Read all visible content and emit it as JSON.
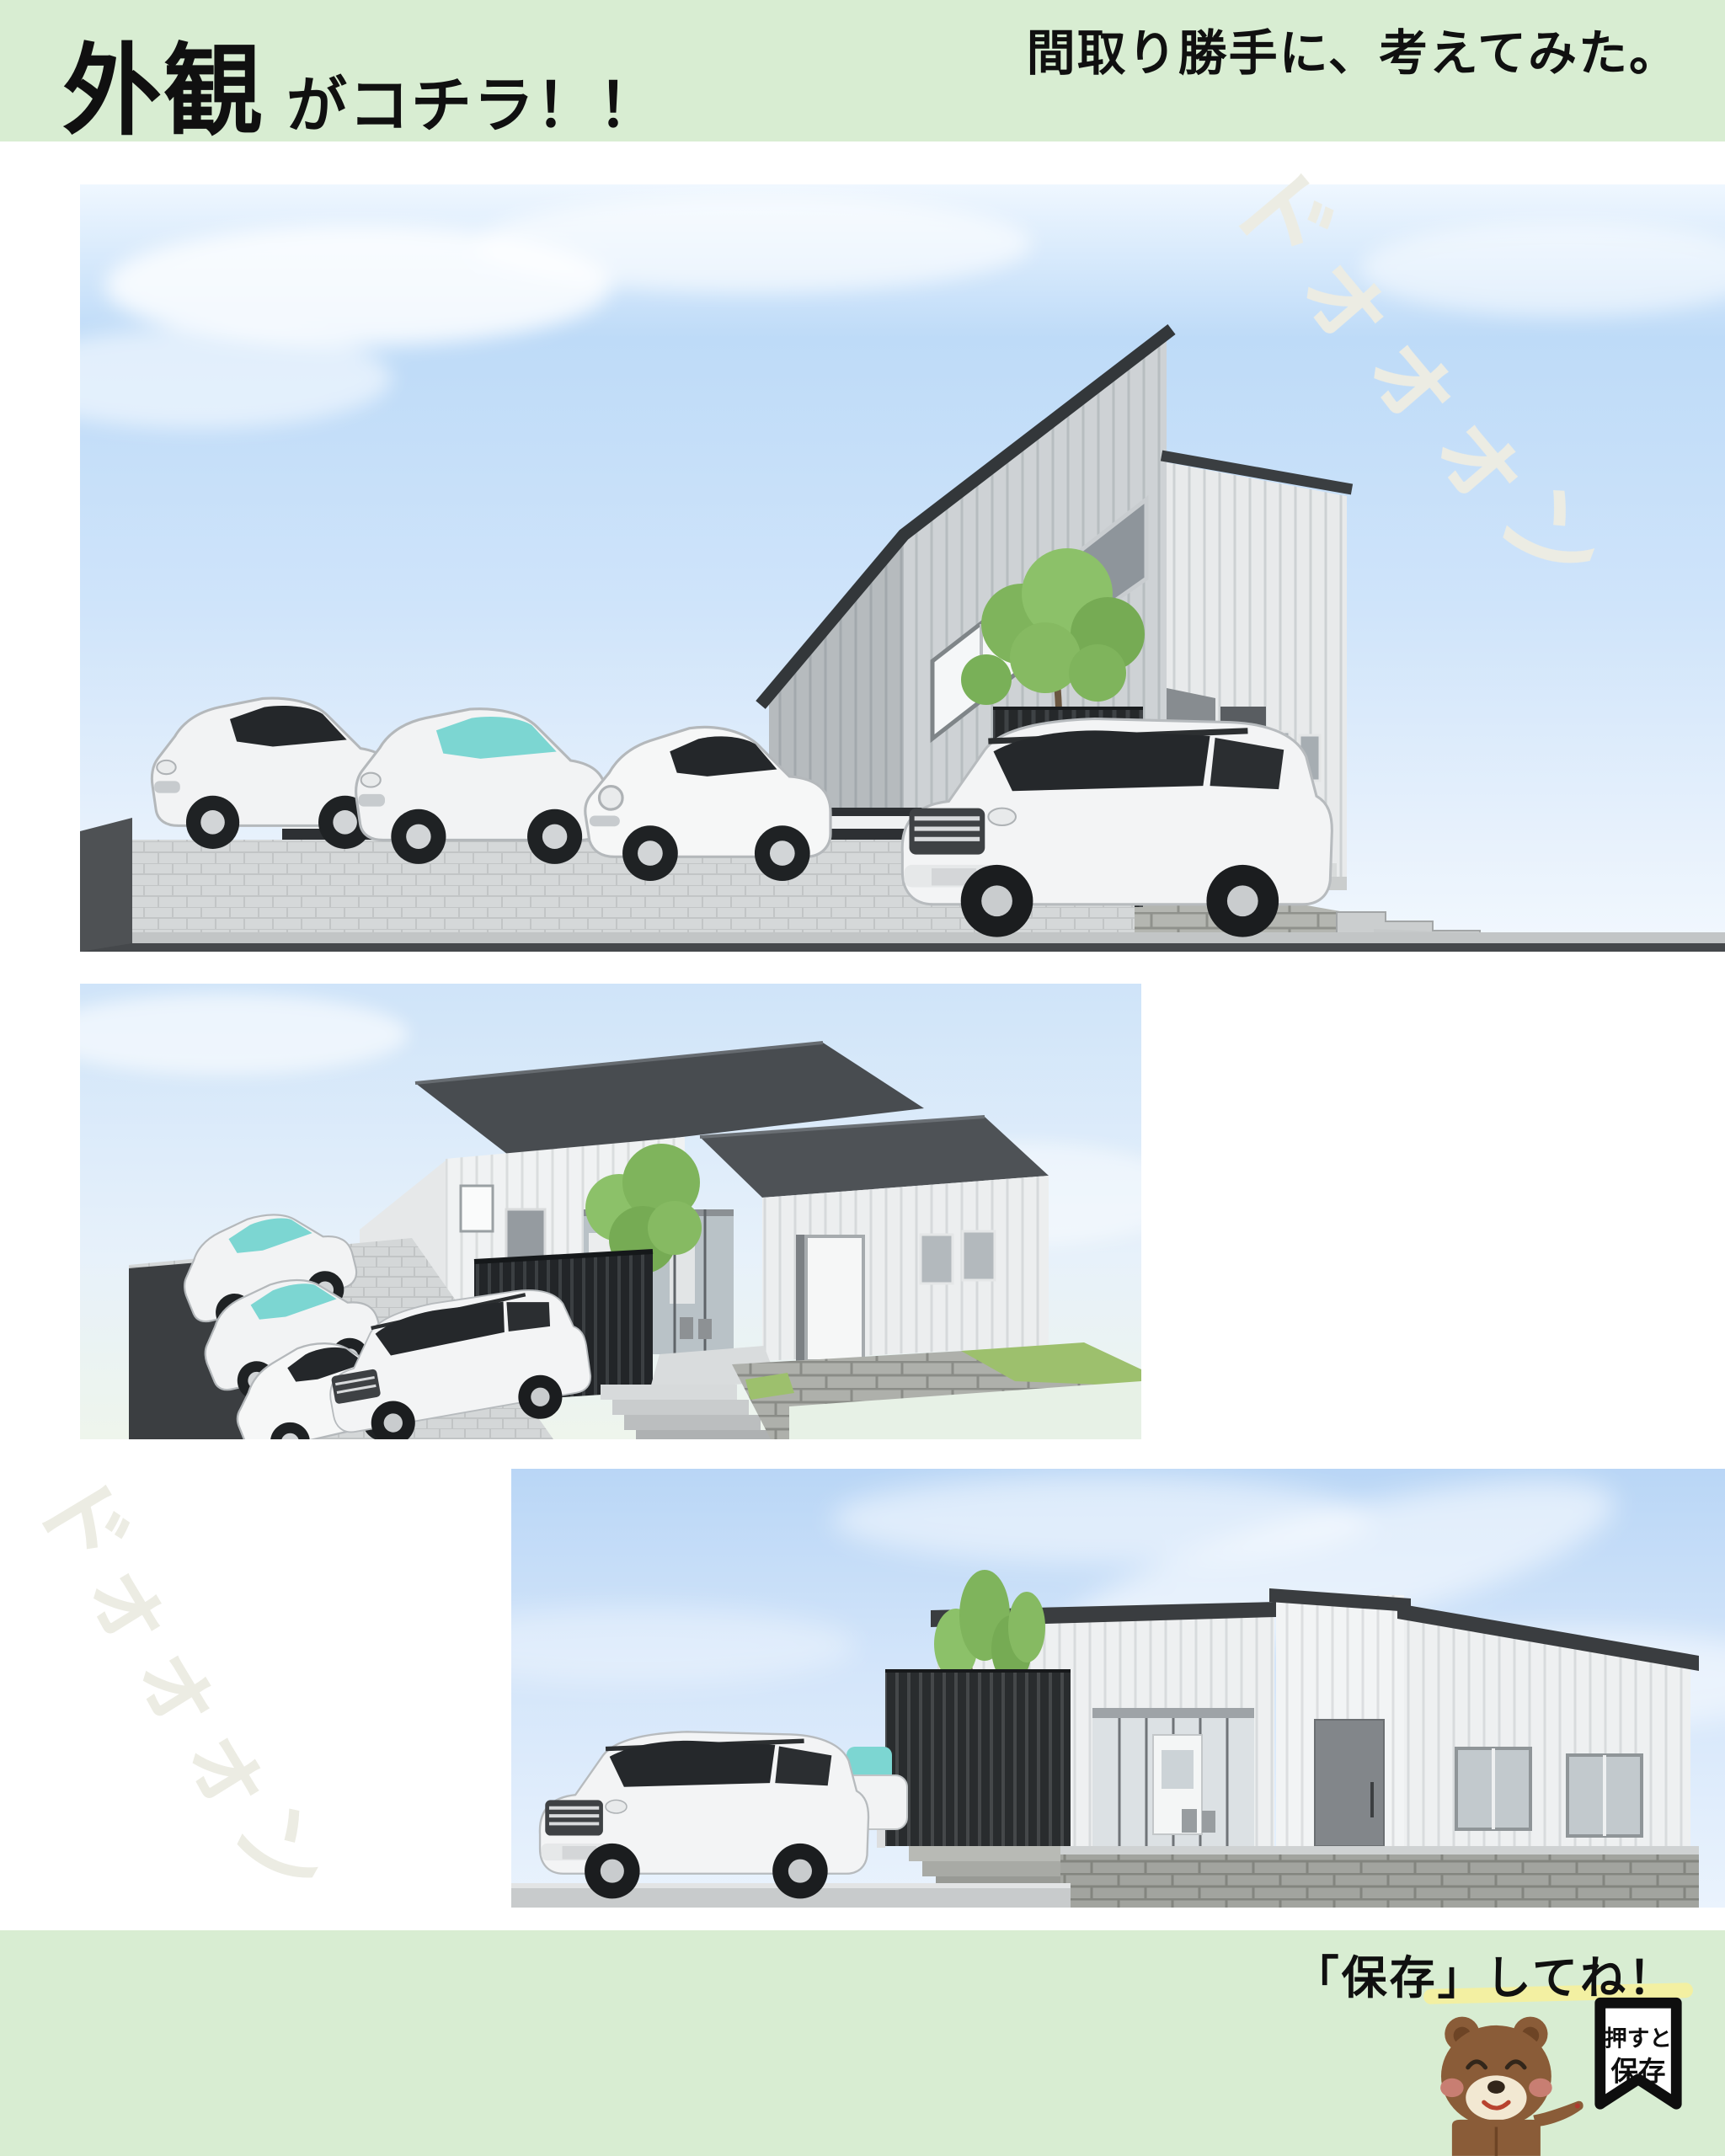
{
  "page": {
    "background": "#ffffff",
    "band_color": "#d8edd2"
  },
  "header": {
    "title_main": "外観",
    "title_sub": "がコチラ！！",
    "note": "間取り勝手に、考えてみた。"
  },
  "sfx": {
    "text": "ドォォォン",
    "color": "#ecece3"
  },
  "renders": [
    {
      "alt": "3D exterior render: two-story flat-roof grey house with slatted fences, stone wall, paver parking, three compact cars and a white SUV"
    },
    {
      "alt": "3D exterior render: aerial view of one-story white house with dark mono-pitch roofs, terrace, black fence, tree, stairs, stone walls and four parked cars"
    },
    {
      "alt": "3D exterior render: street elevation of one-story white house on a stone base with black slatted fence, slim trees and a white SUV"
    }
  ],
  "footer": {
    "save_prompt": "「保存」してね！",
    "highlight_color": "#f3f0a2",
    "mascot": "bear",
    "bookmark": {
      "line1": "押すと",
      "line2": "保存"
    }
  }
}
